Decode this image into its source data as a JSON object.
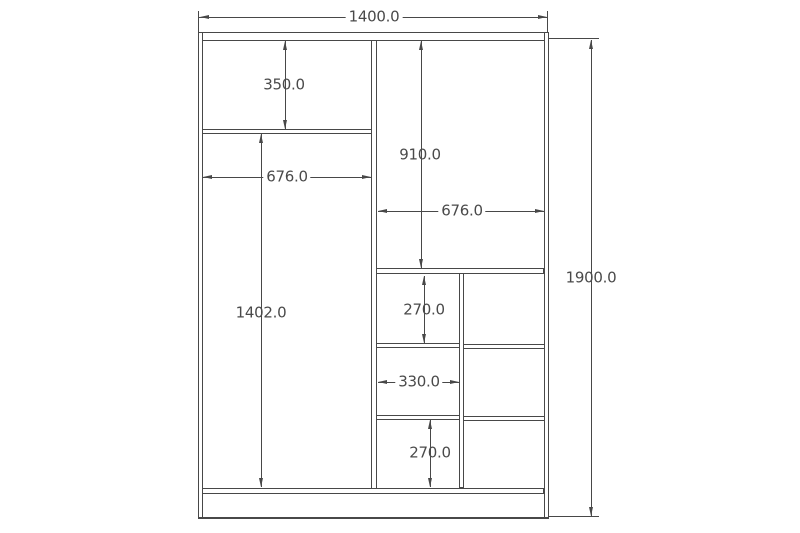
{
  "drawing": {
    "type": "wardrobe-front-elevation-dimension-drawing",
    "units": "mm",
    "line_color": "#484848",
    "text_color": "#4a4a4a",
    "background_color": "#ffffff",
    "dims": {
      "overall_width": "1400.0",
      "overall_height": "1900.0",
      "left_top_compartment_height": "350.0",
      "left_section_width": "676.0",
      "left_main_compartment_height": "1402.0",
      "right_top_compartment_height": "910.0",
      "right_section_width": "676.0",
      "cubby_upper_height": "270.0",
      "cubby_column_width": "330.0",
      "cubby_lower_height": "270.0"
    }
  }
}
